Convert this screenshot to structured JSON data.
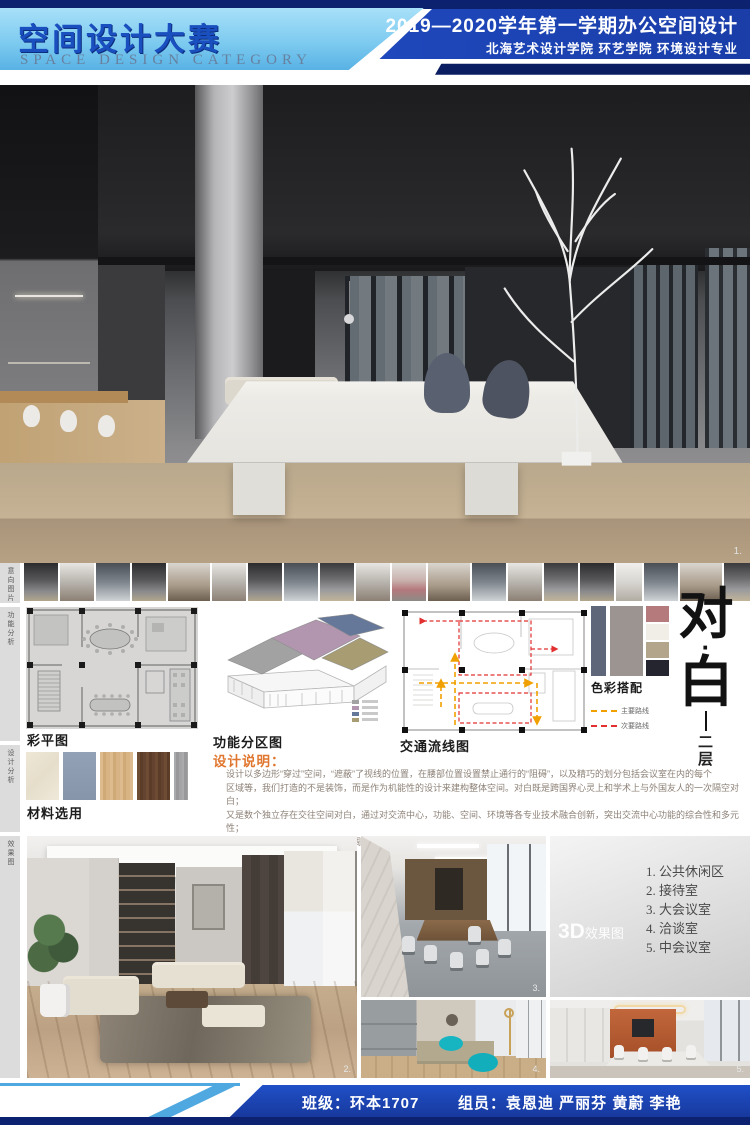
{
  "header": {
    "title_cn": "空间设计大赛",
    "title_en": "SPACE DESIGN CATEGORY",
    "course_line": "2019—2020学年第一学期办公空间设计",
    "school_line": "北海艺术设计学院 环艺学院 环境设计专业"
  },
  "hero": {
    "photo_number": "1."
  },
  "sidebar": {
    "labels": [
      "意向图片",
      "功能分析",
      "设计分析",
      "效果图"
    ]
  },
  "plans": {
    "color_plan_label": "彩平图",
    "zoning_label": "功能分区图",
    "circulation_label": "交通流线图",
    "zoning_colors": [
      "#a2a2a2",
      "#b295af",
      "#66789a",
      "#a89c72"
    ],
    "legend": [
      {
        "label": "主要路线",
        "color": "#f0a000"
      },
      {
        "label": "次要路线",
        "color": "#e23030"
      }
    ]
  },
  "palette": {
    "label": "色彩搭配",
    "colors": [
      "#5d6779",
      "#9b9491",
      "#b57a7b",
      "#f1eee8",
      "#b2a58b",
      "#24252f"
    ]
  },
  "materials": {
    "label": "材料选用",
    "colors": [
      "#ece5d4",
      "#8e9cb2",
      "#d7b488",
      "#6a4832",
      "#a7a7a9"
    ]
  },
  "description": {
    "title": "设计说明：",
    "lines": [
      "设计以多边形“穿过”空间，“遮蔽”了视线的位置，在腰部位置设置禁止通行的“阻碍”，以及精巧的划分包括会议室在内的每个",
      "区域等，我们打造的不是装饰，而是作为机能性的设计来建构整体空间。对白既是跨国界心灵上和学术上与外国友人的一次隔空对白；",
      "又是数个独立存在交往空间对白，通过对交流中心，功能、空间、环境等各专业技术融合创新，突出交流中心功能的综合性和多元性；",
      "更是浅木色和牙白交织出和谐曲调的对白，激起幽幽黛蓝，宕起空间的涟漪。"
    ]
  },
  "project_title": {
    "char1": "对",
    "dot": "·",
    "char2": "白",
    "floor_line1": "二",
    "floor_line2": "层"
  },
  "renders": {
    "label_3d": "3D",
    "label_3d_rest": "效果图",
    "room_list": [
      "1. 公共休闲区",
      "2. 接待室",
      "3. 大会议室",
      "4. 洽谈室",
      "5. 中会议室"
    ],
    "num_lounge": "2.",
    "num_conference": "3.",
    "num_bean": "4.",
    "num_orange": "5."
  },
  "footer": {
    "class_text": "班级：环本1707",
    "members_text": "组员：袁恩迪  严丽芬  黄蔚  李艳"
  }
}
